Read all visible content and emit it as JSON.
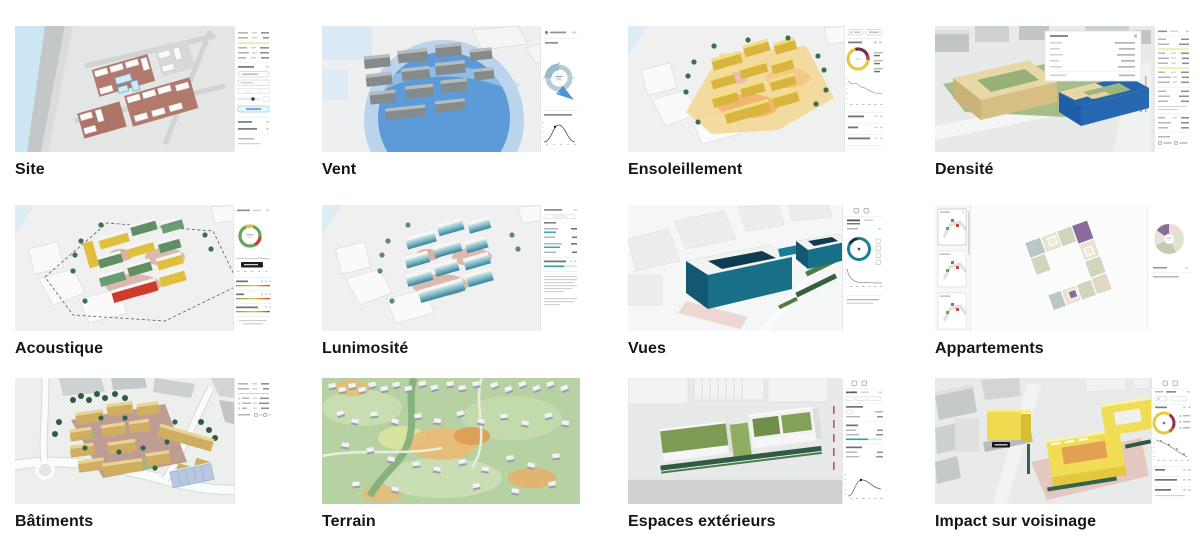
{
  "gallery": {
    "cards": [
      {
        "id": "site",
        "label": "Site"
      },
      {
        "id": "vent",
        "label": "Vent"
      },
      {
        "id": "ensoleillement",
        "label": "Ensoleillement"
      },
      {
        "id": "densite",
        "label": "Densité"
      },
      {
        "id": "acoustique",
        "label": "Acoustique"
      },
      {
        "id": "luminosite",
        "label": "Lunimosité"
      },
      {
        "id": "vues",
        "label": "Vues"
      },
      {
        "id": "appartements",
        "label": "Appartements"
      },
      {
        "id": "batiments",
        "label": "Bâtiments"
      },
      {
        "id": "terrain",
        "label": "Terrain"
      },
      {
        "id": "espaces",
        "label": "Espaces extérieurs"
      },
      {
        "id": "impact",
        "label": "Impact sur voisinage"
      }
    ]
  },
  "palette": {
    "water_blue": "#cde6f3",
    "wind_blue": "#4b90d5",
    "sun_yellow": "#e7c843",
    "sun_dark_arc": "#6d2d53",
    "density_blue": "#2163ac",
    "density_beige": "#e8d8a8",
    "noise_green": "#69a25f",
    "noise_yellow": "#e2c23e",
    "noise_red": "#cd3b29",
    "daylight_teal": "#2aa3a5",
    "views_teal": "#1e7f93",
    "apartment_purple": "#8b6b9b",
    "building_tan": "#cfae63",
    "terrain_green": "#b7d2a2",
    "terrain_orange": "#eaba74",
    "outdoor_green": "#7d9b52",
    "impact_yellow": "#f0da4e",
    "panel_divider_yellow": "#ead977",
    "label_color": "#151515"
  }
}
